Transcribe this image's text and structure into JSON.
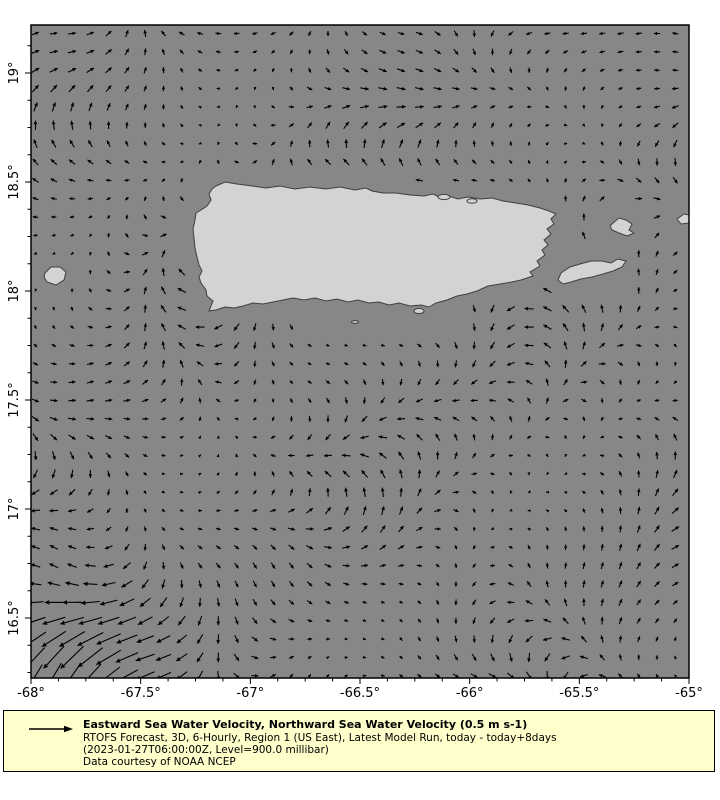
{
  "figure": {
    "width": 720,
    "height": 800,
    "background": "#ffffff"
  },
  "map": {
    "sea_color": "#878787",
    "land_color": "#d3d3d3",
    "coast_color": "#3f3f3f",
    "arrow_color": "#000000",
    "frame_color": "#000000",
    "plot_px": {
      "left": 31,
      "top": 25,
      "right": 689,
      "bottom": 678
    },
    "lon_min": -68,
    "lon_max": -65,
    "lat_top": 19.22,
    "lat_bottom": 16.22,
    "x_ticks": [
      {
        "label": "-68°",
        "px": 31
      },
      {
        "label": "-67.5°",
        "px": 140.7
      },
      {
        "label": "-67°",
        "px": 250.3
      },
      {
        "label": "-66.5°",
        "px": 360
      },
      {
        "label": "-66°",
        "px": 469.7
      },
      {
        "label": "-65.5°",
        "px": 579.3
      },
      {
        "label": "-65°",
        "px": 689
      }
    ],
    "y_ticks": [
      {
        "label": "19°",
        "py": 73
      },
      {
        "label": "18.5°",
        "py": 182
      },
      {
        "label": "18°",
        "py": 291
      },
      {
        "label": "17.5°",
        "py": 400
      },
      {
        "label": "17°",
        "py": 509
      },
      {
        "label": "16.5°",
        "py": 618
      }
    ],
    "minor_step_x_px": 27.4167,
    "minor_step_y_px": 27.25,
    "major_tick_len": 6,
    "minor_tick_len": 3.5,
    "tick_label_font_px": 13
  },
  "vector_field": {
    "reference_label": "0.5 m s-1",
    "grid": {
      "x0": 35.5,
      "y0": 33.5,
      "dx": 18.28,
      "dy": 18.35,
      "cols": 36,
      "rows": 36
    },
    "style": {
      "stroke_width": 1.1
    },
    "angle_terms": {
      "a1": 2.6,
      "f1x": 0.0095,
      "p1": 1.2,
      "a2": 2.1,
      "f2y": 0.012,
      "p2": -0.5,
      "a3": 1.7,
      "f3": 0.0085,
      "a4": 0.8,
      "f4x": 0.027,
      "f4y": 0.023
    },
    "length_terms": {
      "base": 4.2,
      "amp1": 3.2,
      "f1": 0.0083,
      "f2": 0.0102,
      "amp2": 2.2,
      "f3": 0.019,
      "f4": 0.016
    },
    "corner_jet": {
      "x": 70,
      "y": 668,
      "falloff": 7000,
      "extra_len": 16,
      "u": -10,
      "v": 6
    }
  },
  "islands": {
    "puerto_rico": [
      216,
      186,
      225,
      182,
      237,
      184,
      252,
      186,
      266,
      188,
      280,
      186,
      295,
      189,
      310,
      187,
      326,
      189,
      340,
      187,
      355,
      190,
      366,
      188,
      372,
      191,
      383,
      193,
      396,
      193,
      410,
      195,
      424,
      196,
      433,
      194,
      441,
      198,
      449,
      196,
      458,
      199,
      468,
      197,
      480,
      199,
      492,
      198,
      503,
      201,
      516,
      203,
      528,
      205,
      540,
      208,
      549,
      211,
      556,
      214,
      551,
      219,
      554,
      224,
      547,
      229,
      551,
      234,
      544,
      240,
      548,
      245,
      542,
      250,
      545,
      255,
      537,
      261,
      540,
      266,
      530,
      272,
      533,
      276,
      521,
      280,
      512,
      282,
      500,
      284,
      488,
      286,
      477,
      291,
      467,
      294,
      457,
      296,
      447,
      300,
      436,
      303,
      429,
      307,
      421,
      305,
      410,
      306,
      399,
      303,
      389,
      305,
      379,
      302,
      369,
      303,
      358,
      300,
      348,
      302,
      337,
      299,
      326,
      301,
      315,
      298,
      304,
      300,
      293,
      298,
      283,
      300,
      273,
      302,
      263,
      304,
      253,
      303,
      243,
      306,
      234,
      308,
      225,
      307,
      216,
      310,
      209,
      311,
      211,
      306,
      213,
      301,
      207,
      296,
      206,
      290,
      201,
      283,
      199,
      277,
      202,
      271,
      199,
      265,
      197,
      257,
      195,
      248,
      194,
      238,
      193,
      229,
      195,
      220,
      196,
      213,
      201,
      210,
      207,
      206,
      211,
      200,
      209,
      194,
      212,
      189
    ],
    "vieques": [
      561,
      273,
      570,
      267,
      580,
      264,
      591,
      261,
      602,
      261,
      611,
      263,
      618,
      259,
      626,
      261,
      622,
      267,
      613,
      271,
      603,
      274,
      592,
      277,
      581,
      279,
      571,
      282,
      563,
      284,
      558,
      280
    ],
    "culebra": [
      613,
      223,
      619,
      218,
      626,
      220,
      632,
      224,
      629,
      230,
      634,
      233,
      627,
      236,
      619,
      233,
      612,
      230,
      610,
      226
    ],
    "st_thomas": [
      677,
      219,
      684,
      214,
      689,
      215,
      689,
      223,
      681,
      224
    ],
    "mona": [
      45,
      273,
      51,
      267,
      60,
      267,
      66,
      272,
      64,
      280,
      56,
      285,
      47,
      282,
      44,
      277
    ],
    "islets": [
      {
        "cx": 444,
        "cy": 197,
        "rx": 6,
        "ry": 2.6
      },
      {
        "cx": 472,
        "cy": 201,
        "rx": 5,
        "ry": 2.2
      },
      {
        "cx": 419,
        "cy": 311,
        "rx": 5,
        "ry": 2.6
      },
      {
        "cx": 355,
        "cy": 322,
        "rx": 3.5,
        "ry": 1.4
      }
    ]
  },
  "mask": {
    "vertex_buffer_px": 15,
    "circles": [
      {
        "cx": 592,
        "cy": 271,
        "r": 36
      },
      {
        "cx": 622,
        "cy": 227,
        "r": 30
      },
      {
        "cx": 684,
        "cy": 219,
        "r": 24
      },
      {
        "cx": 55,
        "cy": 276,
        "r": 20
      }
    ],
    "ellipses": [
      {
        "cx": 380,
        "cy": 318,
        "rx": 85,
        "ry": 26
      }
    ]
  },
  "legend": {
    "bg_color": "#ffffcc",
    "border_color": "#000000",
    "arrow_color": "#000000",
    "title": "Eastward Sea Water Velocity, Northward Sea Water Velocity (0.5 m s-1)",
    "subtitle": "RTOFS Forecast, 3D, 6-Hourly, Region 1 (US East), Latest Model Run, today - today+8days",
    "run_info": "(2023-01-27T06:00:00Z, Level=900.0 millibar)",
    "credit": "Data courtesy of NOAA NCEP"
  }
}
